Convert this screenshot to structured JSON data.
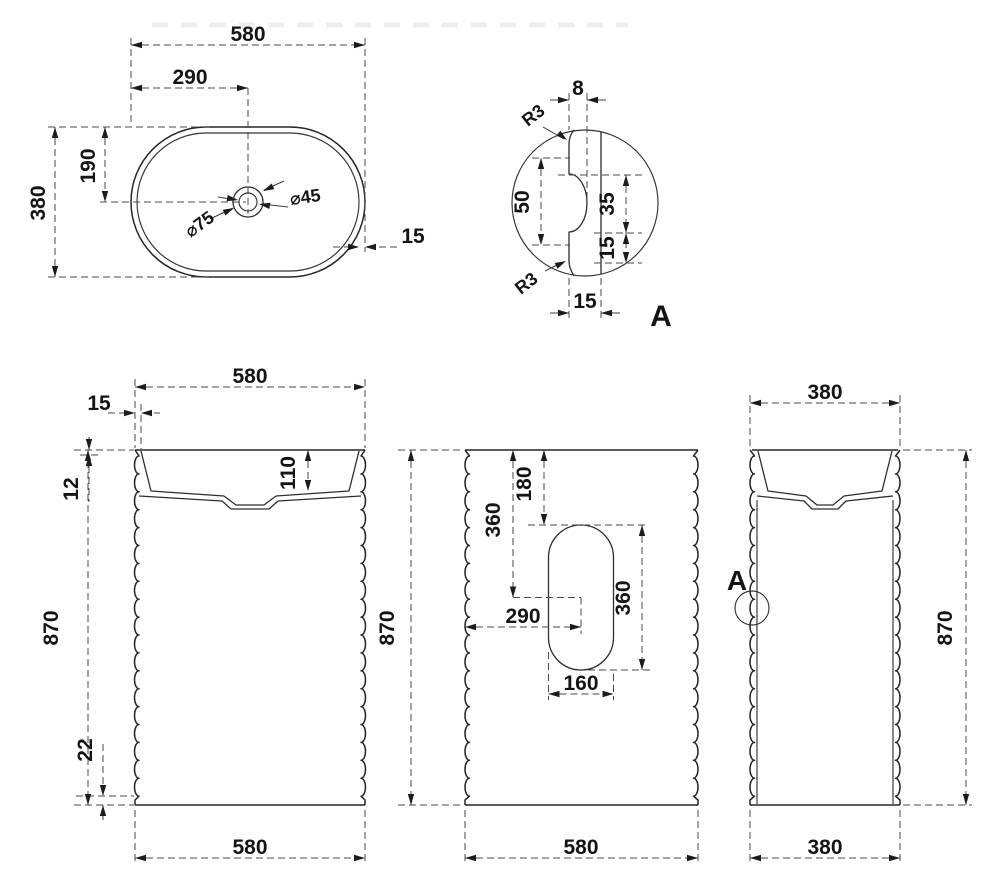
{
  "top_view": {
    "overall_width": "580",
    "drain_offset_x": "290",
    "drain_offset_y": "190",
    "overall_depth": "380",
    "drain_outer_dia": "⌀75",
    "drain_inner_dia": "⌀45",
    "wall_thickness": "15"
  },
  "detail_a": {
    "label": "A",
    "flute_depth": "8",
    "fillet_top": "R3",
    "fillet_bottom": "R3",
    "groove_pitch": "50",
    "groove_height": "35",
    "groove_gap": "15",
    "wall_thickness": "15"
  },
  "front_view": {
    "top_width": "580",
    "wall_thickness": "15",
    "rim_height": "12",
    "basin_depth": "110",
    "height": "870",
    "base_gap": "22",
    "bottom_width": "580"
  },
  "back_view": {
    "height": "870",
    "cutout_top_offset": "180",
    "cutout_center_offset": "360",
    "cutout_center_x": "290",
    "cutout_height": "360",
    "cutout_width": "160",
    "bottom_width": "580"
  },
  "side_view": {
    "top_width": "380",
    "detail_marker": "A",
    "height": "870",
    "bottom_width": "380"
  }
}
